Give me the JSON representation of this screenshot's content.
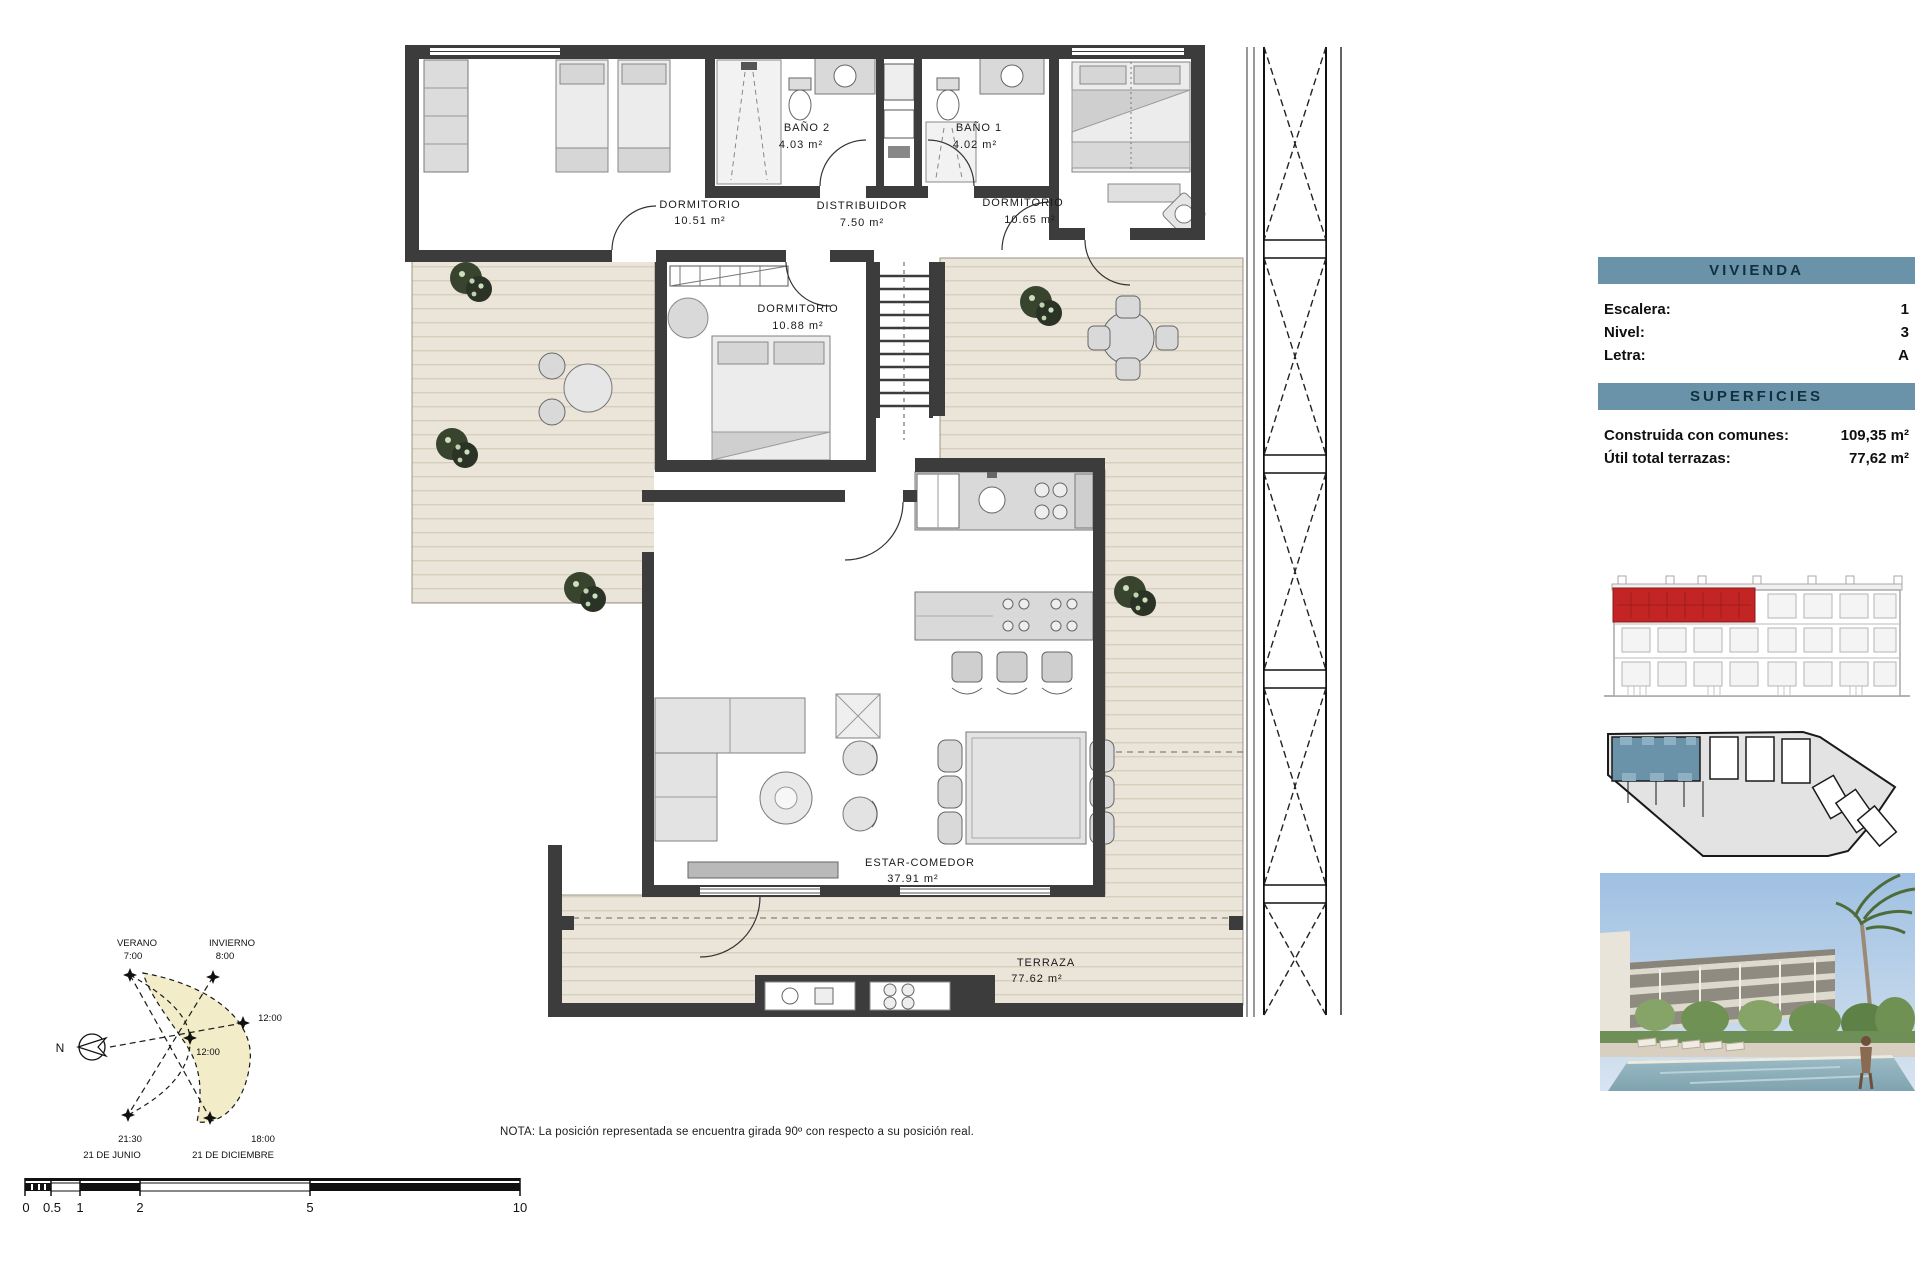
{
  "panel": {
    "vivienda_title": "VIVIENDA",
    "vivienda_rows": [
      {
        "label": "Escalera:",
        "value": "1"
      },
      {
        "label": "Nivel:",
        "value": "3"
      },
      {
        "label": "Letra:",
        "value": "A"
      }
    ],
    "superficies_title": "SUPERFICIES",
    "superficies_rows": [
      {
        "label": "Construida con comunes:",
        "value": "109,35 m²"
      },
      {
        "label": "Útil total terrazas:",
        "value": "77,62 m²"
      }
    ]
  },
  "plan": {
    "rooms": {
      "dorm1": {
        "name": "DORMITORIO",
        "area": "10.51 m²"
      },
      "bano2": {
        "name": "BAÑO 2",
        "area": "4.03 m²"
      },
      "distribuidor": {
        "name": "DISTRIBUIDOR",
        "area": "7.50 m²"
      },
      "bano1": {
        "name": "BAÑO 1",
        "area": "4.02 m²"
      },
      "dorm2": {
        "name": "DORMITORIO",
        "area": "10.65 m²"
      },
      "dorm3": {
        "name": "DORMITORIO",
        "area": "10.88 m²"
      },
      "estar": {
        "name": "ESTAR-COMEDOR",
        "area": "37.91 m²"
      },
      "terraza": {
        "name": "TERRAZA",
        "area": "77.62 m²"
      }
    }
  },
  "sun": {
    "north": "N",
    "verano": "VERANO",
    "verano_time": "7:00",
    "invierno": "INVIERNO",
    "invierno_time": "8:00",
    "noon_outer": "12:00",
    "noon_inner": "12:00",
    "junio_time": "21:30",
    "junio_date": "21 DE JUNIO",
    "diciembre_time": "18:00",
    "diciembre_date": "21 DE DICIEMBRE"
  },
  "scale_bar": {
    "ticks": [
      "0",
      "0.5",
      "1",
      "2",
      "5",
      "10"
    ]
  },
  "note": "NOTA: La posición representada se encuentra girada 90º con respecto a su posición real.",
  "colors": {
    "accent": "#6A93AA",
    "highlight_red": "#C22523",
    "highlight_blue": "#6A93AA",
    "wall": "#3C3C3C",
    "terrace_floor": "#EAE5D8",
    "sun_fill": "#F3ECC9"
  }
}
